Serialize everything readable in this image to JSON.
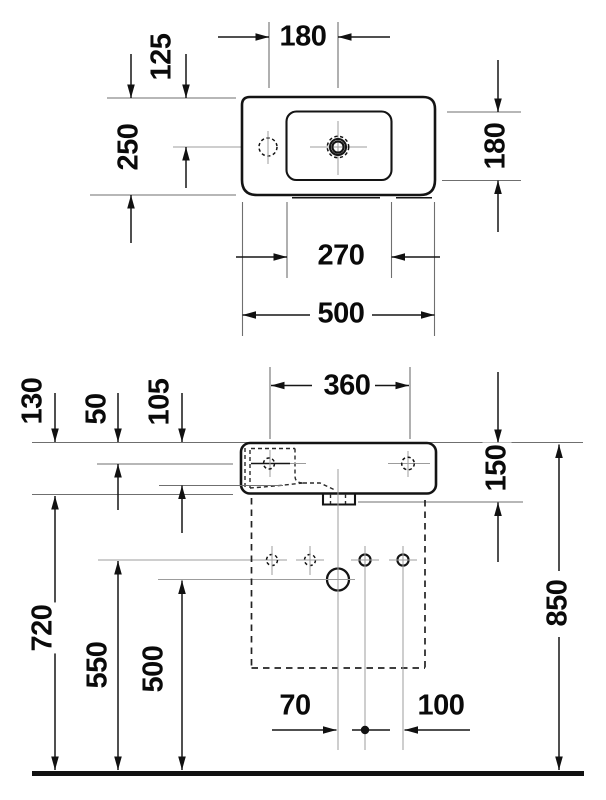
{
  "colors": {
    "line": "#141414",
    "background": "#ffffff",
    "reference_line": "#6f6f6f"
  },
  "dimensions": {
    "plan": {
      "hole_spacing": "180",
      "hole_setback": "125",
      "depth": "250",
      "bowl_depth": "180",
      "bowl_width": "270",
      "width": "500"
    },
    "front": {
      "hanger_spacing": "360",
      "rim_drop": "130",
      "hole_drop": "50",
      "bowl_inner_depth": "105",
      "apron": "150",
      "rim_height": "850",
      "underside_height": "720",
      "hanger_height": "550",
      "drain_height": "500",
      "drain_to_hole": "70",
      "hole_pitch": "100"
    }
  }
}
